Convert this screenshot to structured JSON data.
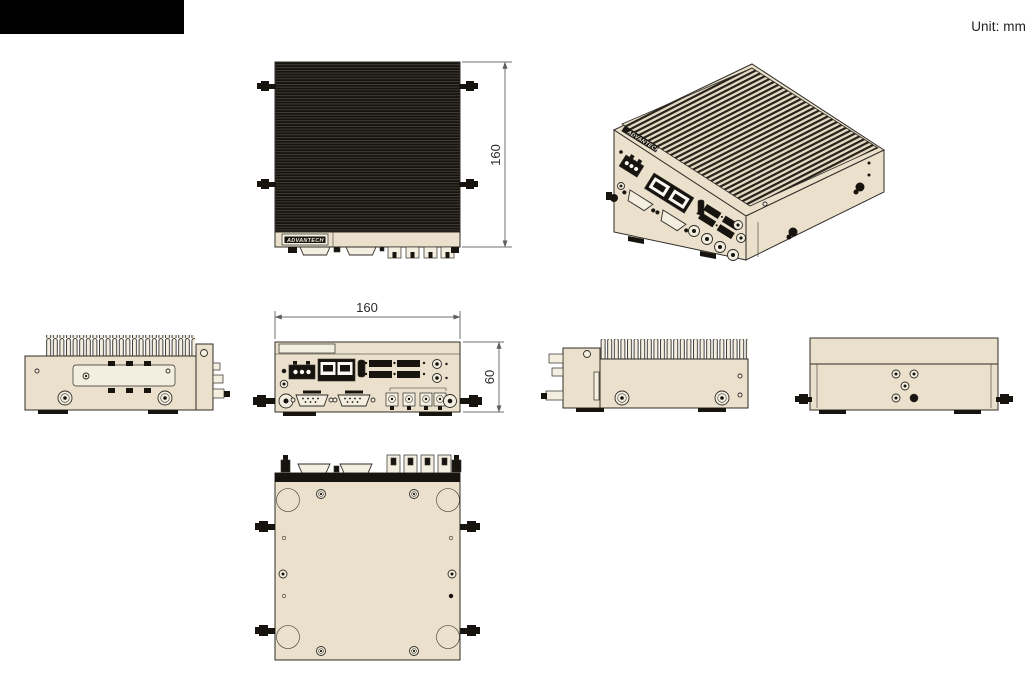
{
  "header": {
    "unit_label": "Unit: mm"
  },
  "branding": {
    "logo_text": "ADVANTECH"
  },
  "dimensions": {
    "chassis_depth": "160",
    "chassis_width": "160",
    "chassis_height": "60"
  },
  "colors": {
    "chassis_tan": "#eae0cb",
    "panel_light": "#f3eee0",
    "fin_dark": "#17140f",
    "outline": "#2f2c27",
    "dimension_line": "#6f6f6f",
    "background": "#ffffff",
    "redacted_bar": "#000000"
  }
}
